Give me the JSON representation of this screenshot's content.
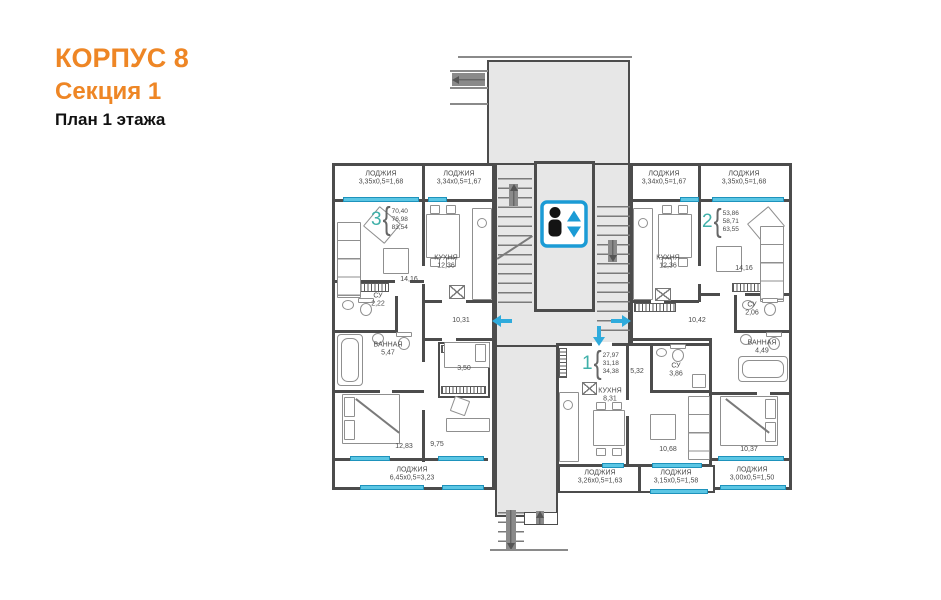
{
  "title": {
    "building": "КОРПУС 8",
    "section": "Секция 1",
    "plan": "План 1 этажа"
  },
  "colors": {
    "accent_orange": "#EE8625",
    "apartment_teal": "#3FB0A9",
    "window_cyan": "#5BC6E4",
    "arrow_cyan": "#2FABDC",
    "elevator_blue": "#1B9BD5",
    "wall_gray": "#4C4C4C"
  },
  "apartments": [
    {
      "number": "3",
      "areas": [
        "70,40",
        "76,98",
        "83,54"
      ]
    },
    {
      "number": "2",
      "areas": [
        "53,86",
        "58,71",
        "63,55"
      ]
    },
    {
      "number": "1",
      "areas": [
        "27,97",
        "31,18",
        "34,38"
      ]
    }
  ],
  "labels": {
    "apt3_loggia_left": {
      "name": "ЛОДЖИЯ",
      "area": "3,35х0,5=1,68"
    },
    "apt3_loggia_kitchen": {
      "name": "ЛОДЖИЯ",
      "area": "3,34х0,5=1,67"
    },
    "apt3_living": {
      "area": "14,16"
    },
    "apt3_kitchen": {
      "name": "КУХНЯ",
      "area": "12,36"
    },
    "apt3_wc": {
      "name": "СУ",
      "area": "2,22"
    },
    "apt3_bath": {
      "name": "ВАННАЯ",
      "area": "5,47"
    },
    "apt3_hall": {
      "area": "10,31"
    },
    "apt3_closet": {
      "area": "3,50"
    },
    "apt3_bedroom": {
      "area": "12,83"
    },
    "apt3_room": {
      "area": "9,75"
    },
    "apt3_loggia_bottom": {
      "name": "ЛОДЖИЯ",
      "area": "6,45х0,5=3,23"
    },
    "apt2_loggia_kitchen": {
      "name": "ЛОДЖИЯ",
      "area": "3,34х0,5=1,67"
    },
    "apt2_loggia_right": {
      "name": "ЛОДЖИЯ",
      "area": "3,35х0,5=1,68"
    },
    "apt2_kitchen": {
      "name": "КУХНЯ",
      "area": "12,36"
    },
    "apt2_living": {
      "area": "14,16"
    },
    "apt2_hall": {
      "area": "10,42"
    },
    "apt2_wc": {
      "name": "СУ",
      "area": "2,06"
    },
    "apt2_bath": {
      "name": "ВАННАЯ",
      "area": "4,49"
    },
    "apt2_bedroom": {
      "area": "10,37"
    },
    "apt2_loggia_bottom": {
      "name": "ЛОДЖИЯ",
      "area": "3,00х0,5=1,50"
    },
    "apt1_kitchen": {
      "name": "КУХНЯ",
      "area": "8,31"
    },
    "apt1_corridor": {
      "area": "5,32"
    },
    "apt1_wc": {
      "name": "СУ",
      "area": "3,86"
    },
    "apt1_living": {
      "area": "10,68"
    },
    "apt1_loggia_kitchen": {
      "name": "ЛОДЖИЯ",
      "area": "3,26х0,5=1,63"
    },
    "apt1_loggia_living": {
      "name": "ЛОДЖИЯ",
      "area": "3,15х0,5=1,58"
    }
  }
}
